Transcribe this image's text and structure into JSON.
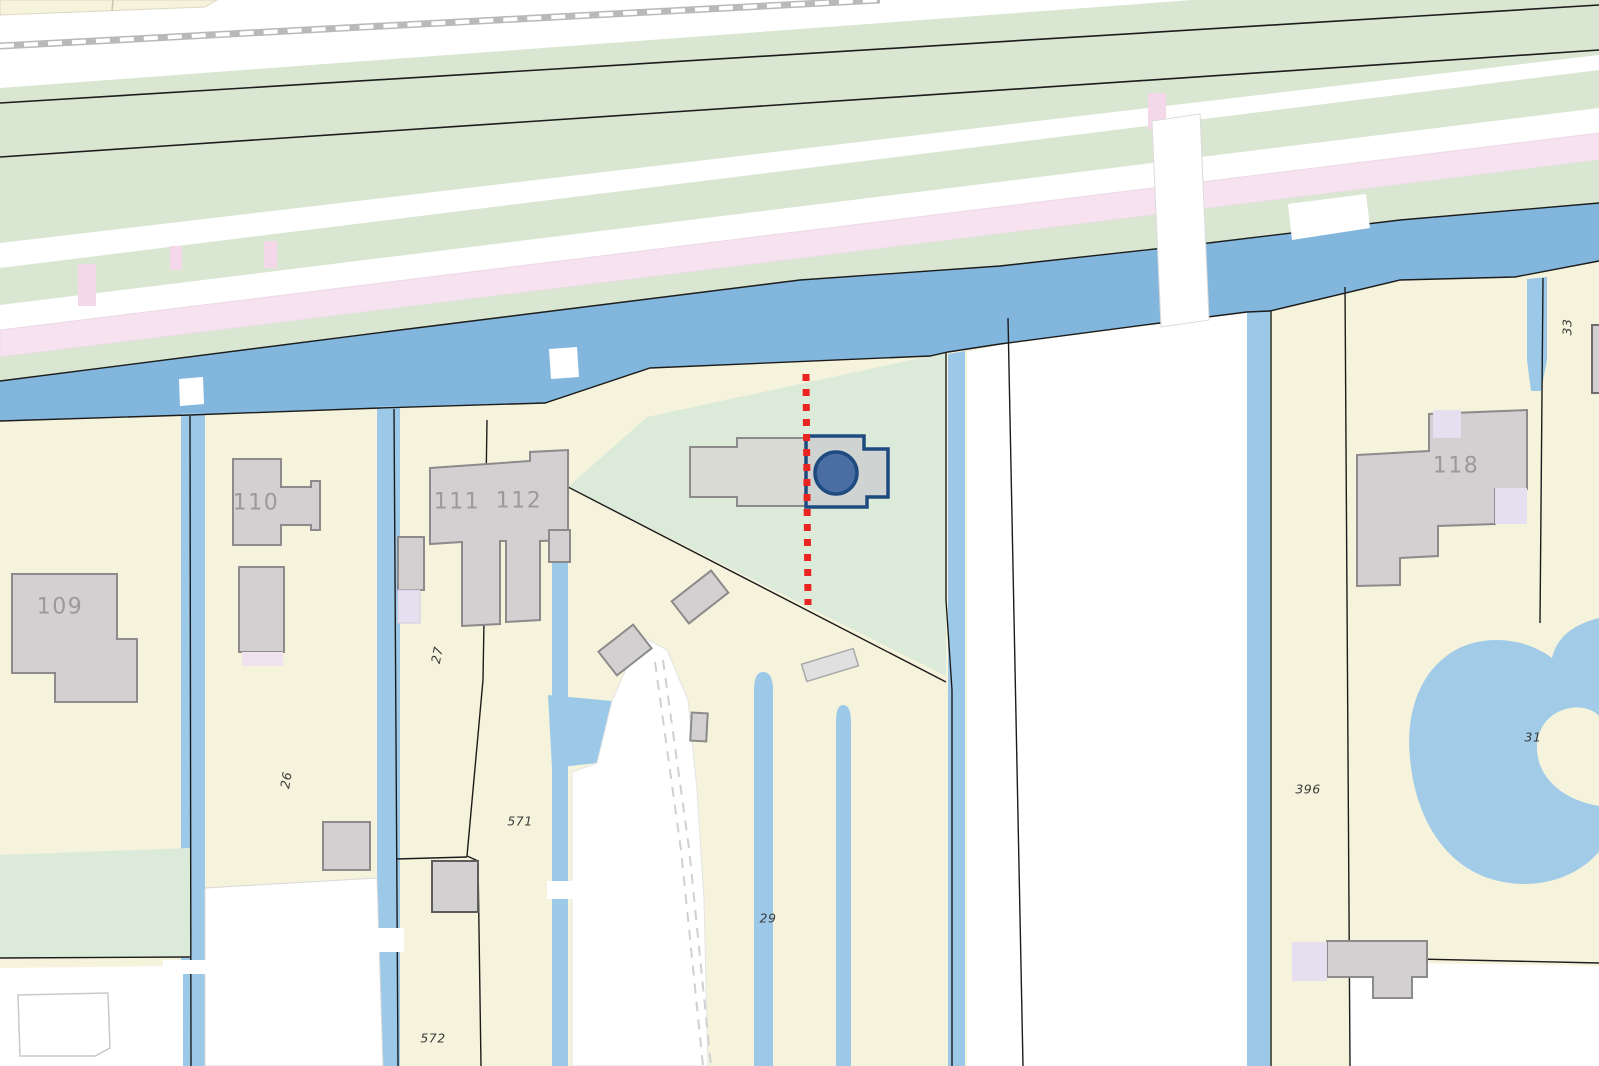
{
  "map": {
    "kind": "cadastral-parcel-map",
    "building_labels": [
      {
        "text": "109"
      },
      {
        "text": "110"
      },
      {
        "text": "111"
      },
      {
        "text": "112"
      },
      {
        "text": "118"
      }
    ],
    "parcel_labels": [
      {
        "text": "27"
      },
      {
        "text": "26"
      },
      {
        "text": "571"
      },
      {
        "text": "572"
      },
      {
        "text": "29"
      },
      {
        "text": "396"
      },
      {
        "text": "31"
      },
      {
        "text": "33"
      }
    ],
    "colors": {
      "parcel_cream": "#f5f3dc",
      "grass_green": "#d9e7d2",
      "selected_parcel_green": "#dcead9",
      "canal_blue": "#82b6dd",
      "ditch_blue": "#9dc9e8",
      "pond_blue": "#a2cbe8",
      "road_white": "#ffffff",
      "road_pink": "#f7e2f0",
      "building_gray": "#d2d0d0",
      "annex_lavender": "#e6dfef",
      "selection_outline_blue": "#1d4b80",
      "marker_fill_blue": "#4a6da4",
      "red_dotted_line": "#ea2420",
      "boundary_black": "#1c1c1c",
      "railway_gray": "#b9b9b9"
    }
  }
}
